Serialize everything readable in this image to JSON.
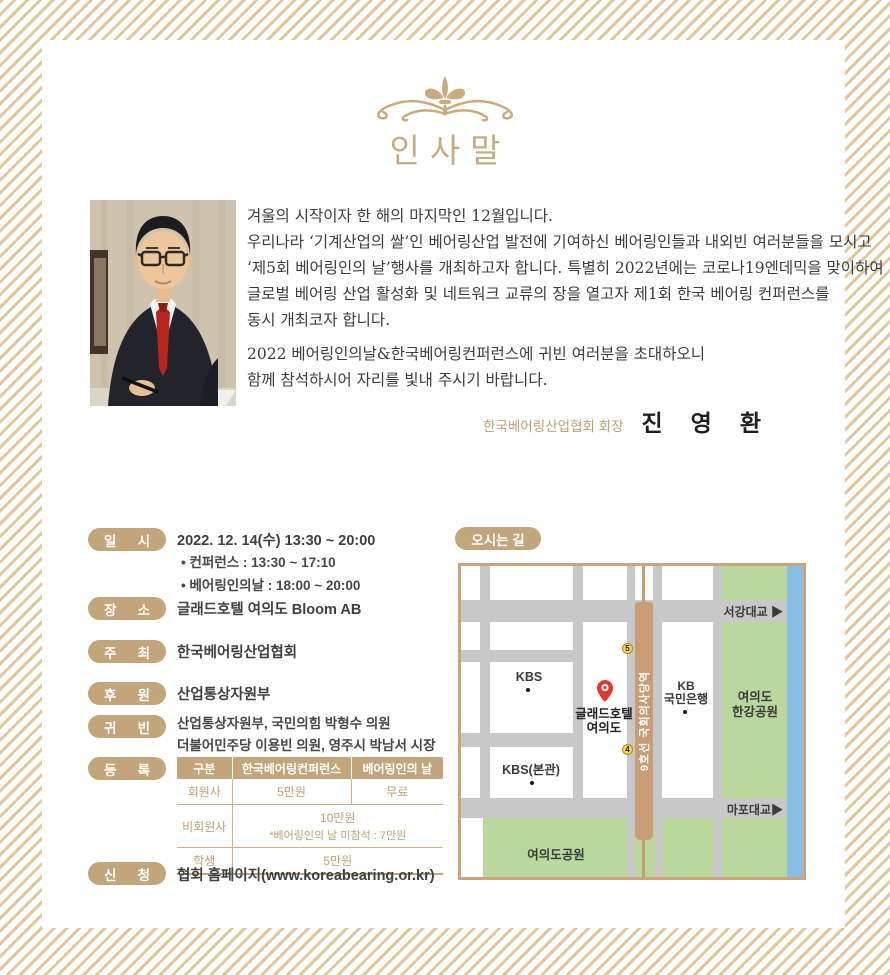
{
  "colors": {
    "accent_tan": "#c3a57b",
    "gold": "#c9ac7d",
    "stripe": "#e0c89c",
    "map_green": "#b9d89c",
    "map_blue": "#8abfe4",
    "map_road": "#c8c8c8",
    "subway_tan": "#c69d74",
    "pin_red": "#e03a2f",
    "exit_yellow": "#ffd93b"
  },
  "header": {
    "title": "인사말"
  },
  "greeting": {
    "p1": [
      "겨울의 시작이자 한 해의 마지막인 12월입니다.",
      "우리나라 ‘기계산업의 쌀’인 베어링산업 발전에 기여하신 베어링인들과 내외빈 여러분들을 모시고",
      "‘제5회 베어링인의 날’행사를 개최하고자 합니다. 특별히 2022년에는 코로나19엔데믹을 맞이하여",
      "글로벌 베어링 산업 활성화 및 네트워크 교류의 장을 열고자 제1회 한국 베어링 컨퍼런스를",
      "동시 개최코자 합니다."
    ],
    "p2": [
      "2022 베어링인의날&한국베어링컨퍼런스에 귀빈 여러분을 초대하오니",
      "함께 참석하시어 자리를 빛내 주시기 바랍니다."
    ],
    "signature_org": "한국베어링산업협회 회장",
    "signature_name": "진 영 환"
  },
  "info": {
    "datetime": {
      "label": [
        "일",
        "시"
      ],
      "main": "2022. 12. 14(수) 13:30 ~ 20:00",
      "bullets": [
        "• 컨퍼런스 : 13:30 ~ 17:10",
        "• 베어링인의날 : 18:00 ~ 20:00"
      ]
    },
    "venue": {
      "label": [
        "장",
        "소"
      ],
      "value": "글래드호텔 여의도 Bloom AB"
    },
    "host": {
      "label": [
        "주",
        "최"
      ],
      "value": "한국베어링산업협회"
    },
    "sponsor": {
      "label": [
        "후",
        "원"
      ],
      "value": "산업통상자원부"
    },
    "vip": {
      "label": [
        "귀",
        "빈"
      ],
      "lines": [
        "산업통상자원부, 국민의힘 박형수 의원",
        "더불어민주당 이용빈 의원, 영주시 박남서 시장"
      ]
    },
    "registration": {
      "label": [
        "등",
        "록"
      ],
      "table": {
        "headers": [
          "구분",
          "한국베어링컨퍼런스",
          "베어링인의 날"
        ],
        "member": {
          "category": "회원사",
          "conference": "5만원",
          "day": "무료"
        },
        "nonmember": {
          "category": "비회원사",
          "fee": "10만원",
          "note": "*베어링인의 날 미참석 : 7만원"
        },
        "student": {
          "category": "학생",
          "fee": "5만원"
        }
      }
    },
    "apply": {
      "label": [
        "신",
        "청"
      ],
      "value": "협회 홈페이지(www.koreabearing.or.kr)"
    }
  },
  "directions": {
    "badge": "오시는 길",
    "map": {
      "subway": "9호선 국회의사당역",
      "exit_top": "5",
      "exit_bottom": "4",
      "kbs": "KBS",
      "kbs_main": "KBS(본관)",
      "hotel": [
        "글래드호텔",
        "여의도"
      ],
      "kb": [
        "KB",
        "국민은행"
      ],
      "hangang_park": [
        "여의도",
        "한강공원"
      ],
      "yeouido_park": "여의도공원",
      "bridge_top": "서강대교 ▶",
      "bridge_bottom": "마포대교▶"
    }
  }
}
